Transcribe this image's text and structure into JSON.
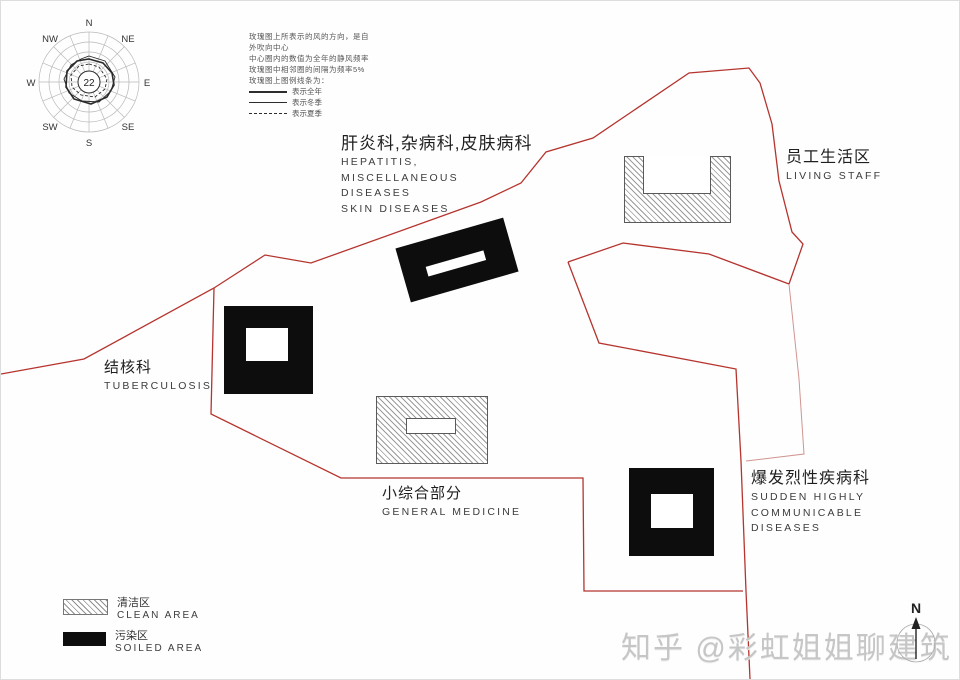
{
  "windrose": {
    "compass": {
      "n": "N",
      "ne": "NE",
      "e": "E",
      "se": "SE",
      "s": "S",
      "sw": "SW",
      "w": "W",
      "nw": "NW"
    },
    "calm_value": "22",
    "description": [
      "玫瑰图上所表示的风的方向，是自",
      "外吹向中心",
      "中心圈内的数值为全年的静风频率",
      "玫瑰图中相邻圈的间隔为频率5%",
      "玫瑰图上图例线条为："
    ],
    "line_legend": [
      {
        "label": "表示全年"
      },
      {
        "label": "表示冬季"
      },
      {
        "label": "表示夏季"
      }
    ]
  },
  "areas": {
    "hepatitis": {
      "zh": "肝炎科,杂病科,皮肤病科",
      "en": [
        "HEPATITIS,",
        "MISCELLANEOUS",
        "DISEASES",
        "SKIN DISEASES"
      ]
    },
    "living_staff": {
      "zh": "员工生活区",
      "en": [
        "LIVING STAFF"
      ]
    },
    "tuberculosis": {
      "zh": "结核科",
      "en": [
        "TUBERCULOSIS"
      ]
    },
    "general_medicine": {
      "zh": "小综合部分",
      "en": [
        "GENERAL MEDICINE"
      ]
    },
    "outbreak": {
      "zh": "爆发烈性疾病科",
      "en": [
        "SUDDEN HIGHLY",
        "COMMUNICABLE",
        "DISEASES"
      ]
    }
  },
  "legend": {
    "clean": {
      "zh": "清洁区",
      "en": "CLEAN AREA"
    },
    "soiled": {
      "zh": "污染区",
      "en": "SOILED AREA"
    }
  },
  "north_label": "N",
  "watermark": "知乎 @彩虹姐姐聊建筑",
  "colors": {
    "boundary": "#b5342e",
    "boundary_light": "#d09490",
    "building_dark": "#0d0d0d"
  }
}
